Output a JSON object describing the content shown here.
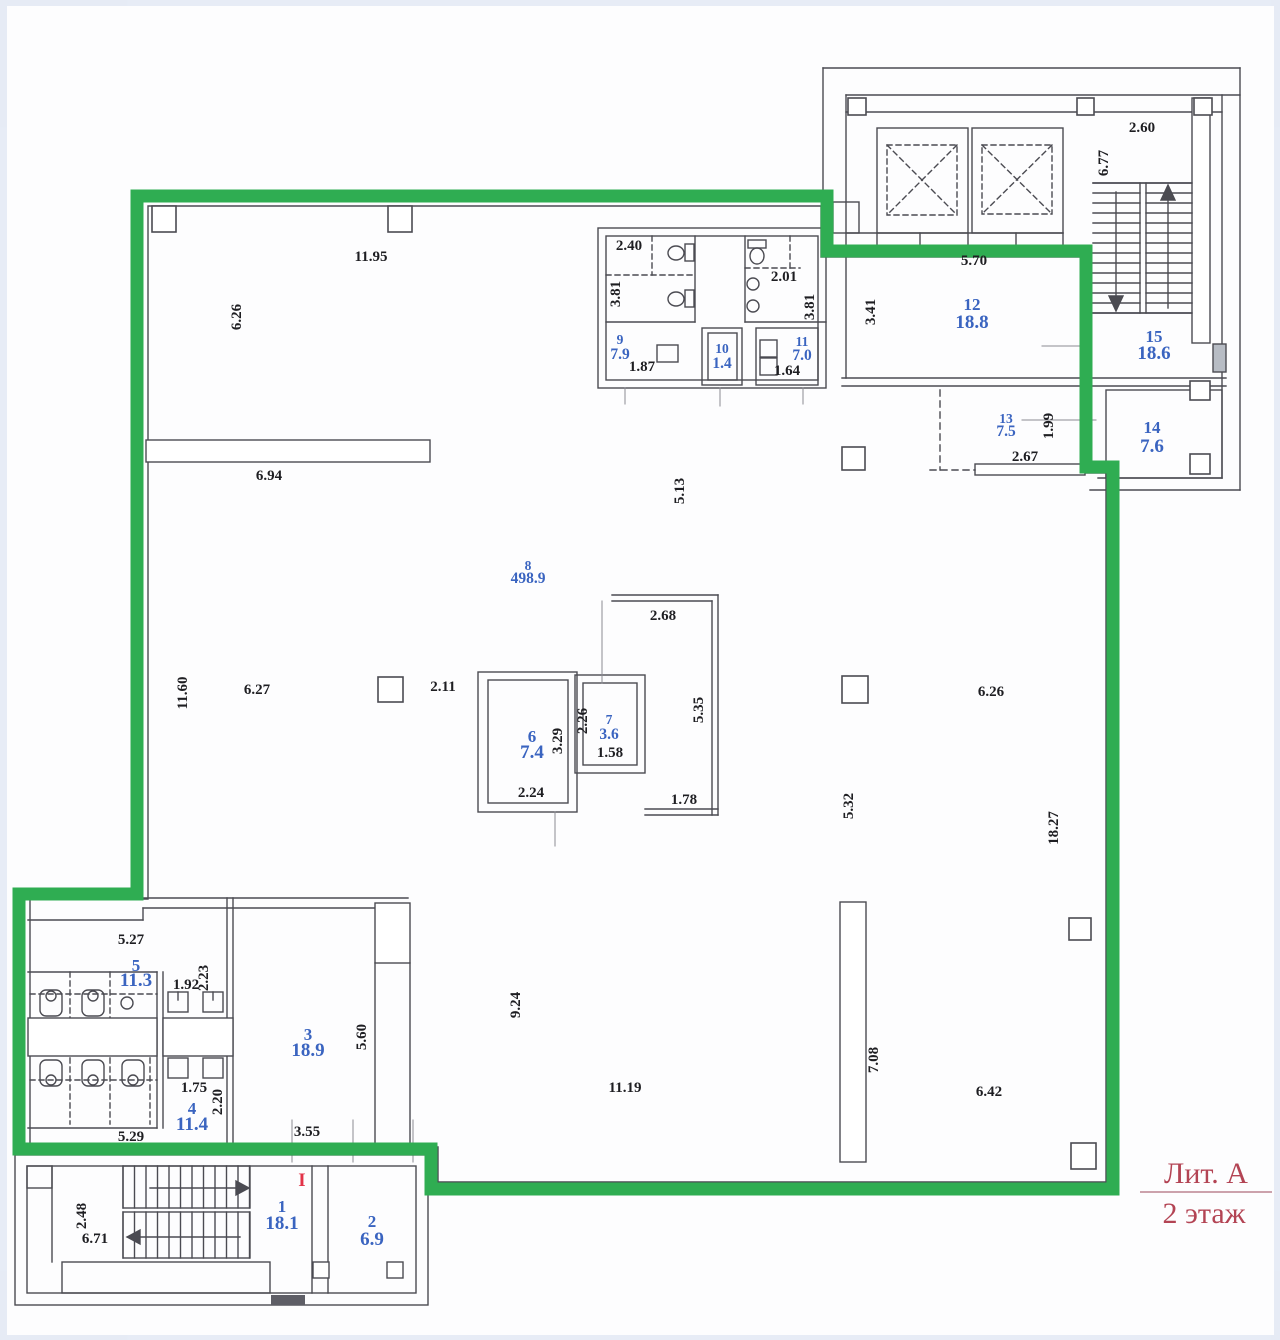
{
  "title": {
    "litera": "Лит. А",
    "floor": "2 этаж"
  },
  "entrance_mark": "I",
  "legend_colors": {
    "boundary_green": "#2fad52",
    "room_label_blue": "#3a64c0",
    "dimension_black": "#1e1e22",
    "title_red": "#b34454",
    "entrance_red": "#e23348"
  },
  "rooms": [
    {
      "num": "1",
      "area": "18.1",
      "x": 282,
      "y": 1212,
      "dy": 17
    },
    {
      "num": "2",
      "area": "6.9",
      "x": 372,
      "y": 1227,
      "dy": 18
    },
    {
      "num": "3",
      "area": "18.9",
      "x": 308,
      "y": 1040,
      "dy": 16
    },
    {
      "num": "4",
      "area": "11.4",
      "x": 192,
      "y": 1114,
      "dy": 16
    },
    {
      "num": "5",
      "area": "11.3",
      "x": 136,
      "y": 971,
      "dy": 15
    },
    {
      "num": "6",
      "area": "7.4",
      "x": 532,
      "y": 742,
      "dy": 16
    },
    {
      "num": "7",
      "area": "3.6",
      "x": 609,
      "y": 724,
      "dy": 15,
      "small": true
    },
    {
      "num": "8",
      "area": "498.9",
      "x": 528,
      "y": 570,
      "dy": 13,
      "small": true
    },
    {
      "num": "9",
      "area": "7.9",
      "x": 620,
      "y": 344,
      "dy": 15,
      "small": true
    },
    {
      "num": "10",
      "area": "1.4",
      "x": 722,
      "y": 353,
      "dy": 15,
      "small": true
    },
    {
      "num": "11",
      "area": "7.0",
      "x": 802,
      "y": 346,
      "dy": 14,
      "small": true
    },
    {
      "num": "12",
      "area": "18.8",
      "x": 972,
      "y": 310,
      "dy": 18
    },
    {
      "num": "13",
      "area": "7.5",
      "x": 1006,
      "y": 423,
      "dy": 13,
      "small": true
    },
    {
      "num": "14",
      "area": "7.6",
      "x": 1152,
      "y": 433,
      "dy": 19
    },
    {
      "num": "15",
      "area": "18.6",
      "x": 1154,
      "y": 342,
      "dy": 17
    }
  ],
  "dimensions": [
    {
      "t": "2.60",
      "x": 1142,
      "y": 132
    },
    {
      "t": "6.77",
      "x": 1108,
      "y": 163,
      "rot": true
    },
    {
      "t": "5.70",
      "x": 974,
      "y": 265
    },
    {
      "t": "3.41",
      "x": 875,
      "y": 312,
      "rot": true
    },
    {
      "t": "1.99",
      "x": 1053,
      "y": 426,
      "rot": true
    },
    {
      "t": "2.67",
      "x": 1025,
      "y": 461
    },
    {
      "t": "2.40",
      "x": 629,
      "y": 250
    },
    {
      "t": "3.81",
      "x": 620,
      "y": 294,
      "rot": true
    },
    {
      "t": "2.01",
      "x": 784,
      "y": 281
    },
    {
      "t": "3.81",
      "x": 814,
      "y": 307,
      "rot": true
    },
    {
      "t": "1.87",
      "x": 642,
      "y": 371
    },
    {
      "t": "1.64",
      "x": 787,
      "y": 375
    },
    {
      "t": "11.95",
      "x": 371,
      "y": 261
    },
    {
      "t": "6.26",
      "x": 241,
      "y": 317,
      "rot": true
    },
    {
      "t": "6.94",
      "x": 269,
      "y": 480
    },
    {
      "t": "5.13",
      "x": 684,
      "y": 491,
      "rot": true
    },
    {
      "t": "2.68",
      "x": 663,
      "y": 620
    },
    {
      "t": "11.60",
      "x": 187,
      "y": 693,
      "rot": true
    },
    {
      "t": "6.27",
      "x": 257,
      "y": 694
    },
    {
      "t": "2.11",
      "x": 443,
      "y": 691
    },
    {
      "t": "6.26",
      "x": 991,
      "y": 696
    },
    {
      "t": "2.26",
      "x": 587,
      "y": 721,
      "rot": true
    },
    {
      "t": "3.29",
      "x": 562,
      "y": 741,
      "rot": true
    },
    {
      "t": "1.58",
      "x": 610,
      "y": 757
    },
    {
      "t": "5.35",
      "x": 703,
      "y": 710,
      "rot": true
    },
    {
      "t": "2.24",
      "x": 531,
      "y": 797
    },
    {
      "t": "1.78",
      "x": 684,
      "y": 804
    },
    {
      "t": "5.32",
      "x": 853,
      "y": 806,
      "rot": true
    },
    {
      "t": "18.27",
      "x": 1058,
      "y": 828,
      "rot": true
    },
    {
      "t": "9.24",
      "x": 520,
      "y": 1005,
      "rot": true
    },
    {
      "t": "11.19",
      "x": 625,
      "y": 1092
    },
    {
      "t": "7.08",
      "x": 878,
      "y": 1060,
      "rot": true
    },
    {
      "t": "6.42",
      "x": 989,
      "y": 1096
    },
    {
      "t": "5.27",
      "x": 131,
      "y": 944
    },
    {
      "t": "1.92",
      "x": 186,
      "y": 989
    },
    {
      "t": "2.23",
      "x": 208,
      "y": 978,
      "rot": true
    },
    {
      "t": "1.75",
      "x": 194,
      "y": 1092
    },
    {
      "t": "2.20",
      "x": 222,
      "y": 1102,
      "rot": true
    },
    {
      "t": "5.29",
      "x": 131,
      "y": 1141
    },
    {
      "t": "5.60",
      "x": 366,
      "y": 1037,
      "rot": true
    },
    {
      "t": "3.55",
      "x": 307,
      "y": 1136
    },
    {
      "t": "2.48",
      "x": 86,
      "y": 1216,
      "rot": true
    },
    {
      "t": "6.71",
      "x": 95,
      "y": 1243
    }
  ]
}
